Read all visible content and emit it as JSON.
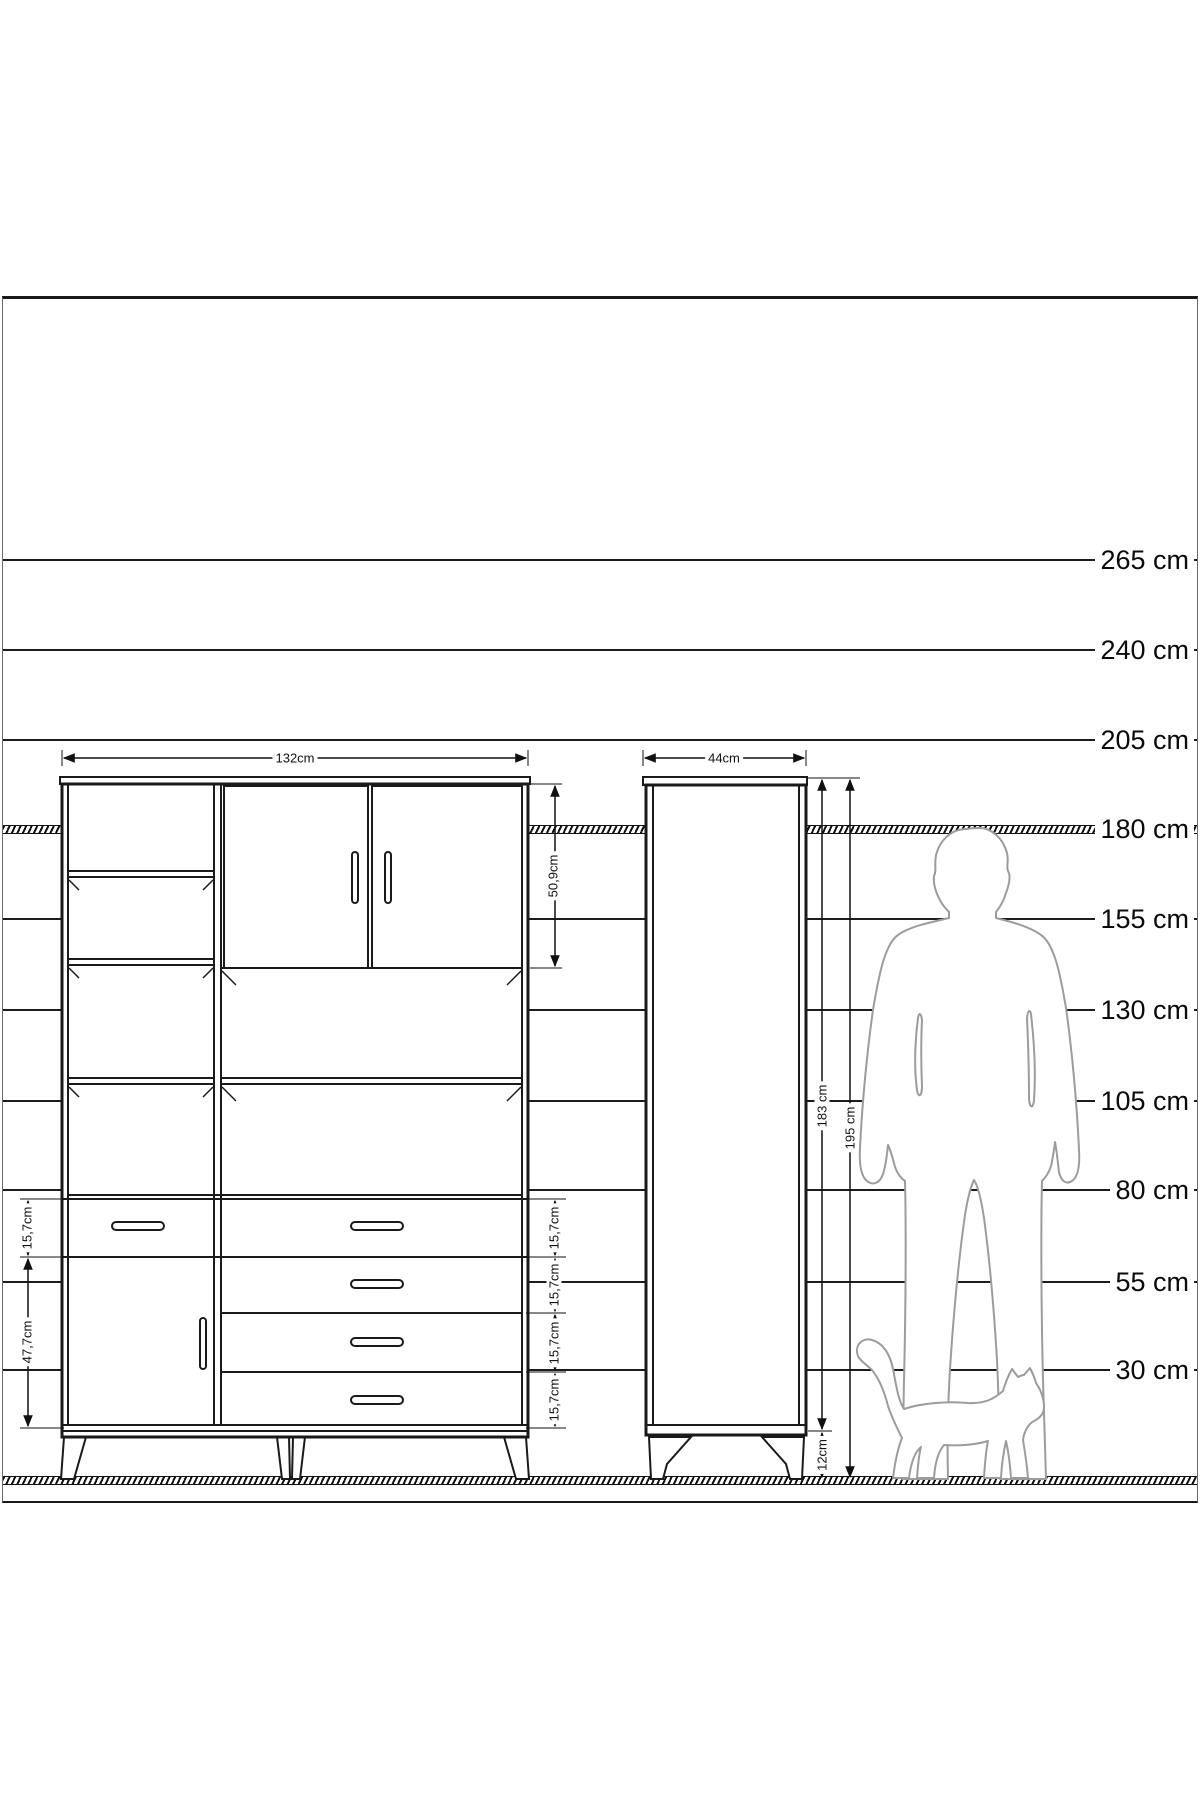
{
  "drawing": {
    "kind": "furniture elevation with height scale",
    "unit": "cm",
    "colors": {
      "line": "#1c1c1c",
      "silhouette": "#9c9c9c",
      "background": "#ffffff"
    }
  },
  "scale": {
    "labels": [
      "265 cm",
      "240 cm",
      "205 cm",
      "180 cm",
      "155 cm",
      "130 cm",
      "105 cm",
      "80 cm",
      "55 cm",
      "30 cm"
    ]
  },
  "wide_cabinet": {
    "width_label": "132cm",
    "upper_section_height_label": "50,9cm",
    "left_top_drawer_label": "15,7cm",
    "left_door_height_label": "47,7cm",
    "drawer_labels": [
      "15,7cm",
      "15,7cm",
      "15,7cm",
      "15,7cm"
    ]
  },
  "tall_cabinet": {
    "width_label": "44cm",
    "body_height_label": "183 cm",
    "total_height_label": "195 cm",
    "leg_height_label": "12cm"
  },
  "figures": {
    "man": "man-silhouette",
    "cat": "cat-silhouette"
  },
  "chart_data": {
    "type": "table",
    "title": "Cabinet dimensions vs human scale",
    "scale_lines_cm": [
      265,
      240,
      205,
      180,
      155,
      130,
      105,
      80,
      55,
      30
    ],
    "wide_cabinet": {
      "width_cm": 132,
      "upper_section_cm": 50.9,
      "drawer_cm": 15.7,
      "door_cm": 47.7
    },
    "tall_cabinet": {
      "width_cm": 44,
      "body_cm": 183,
      "total_cm": 195,
      "legs_cm": 12
    }
  }
}
